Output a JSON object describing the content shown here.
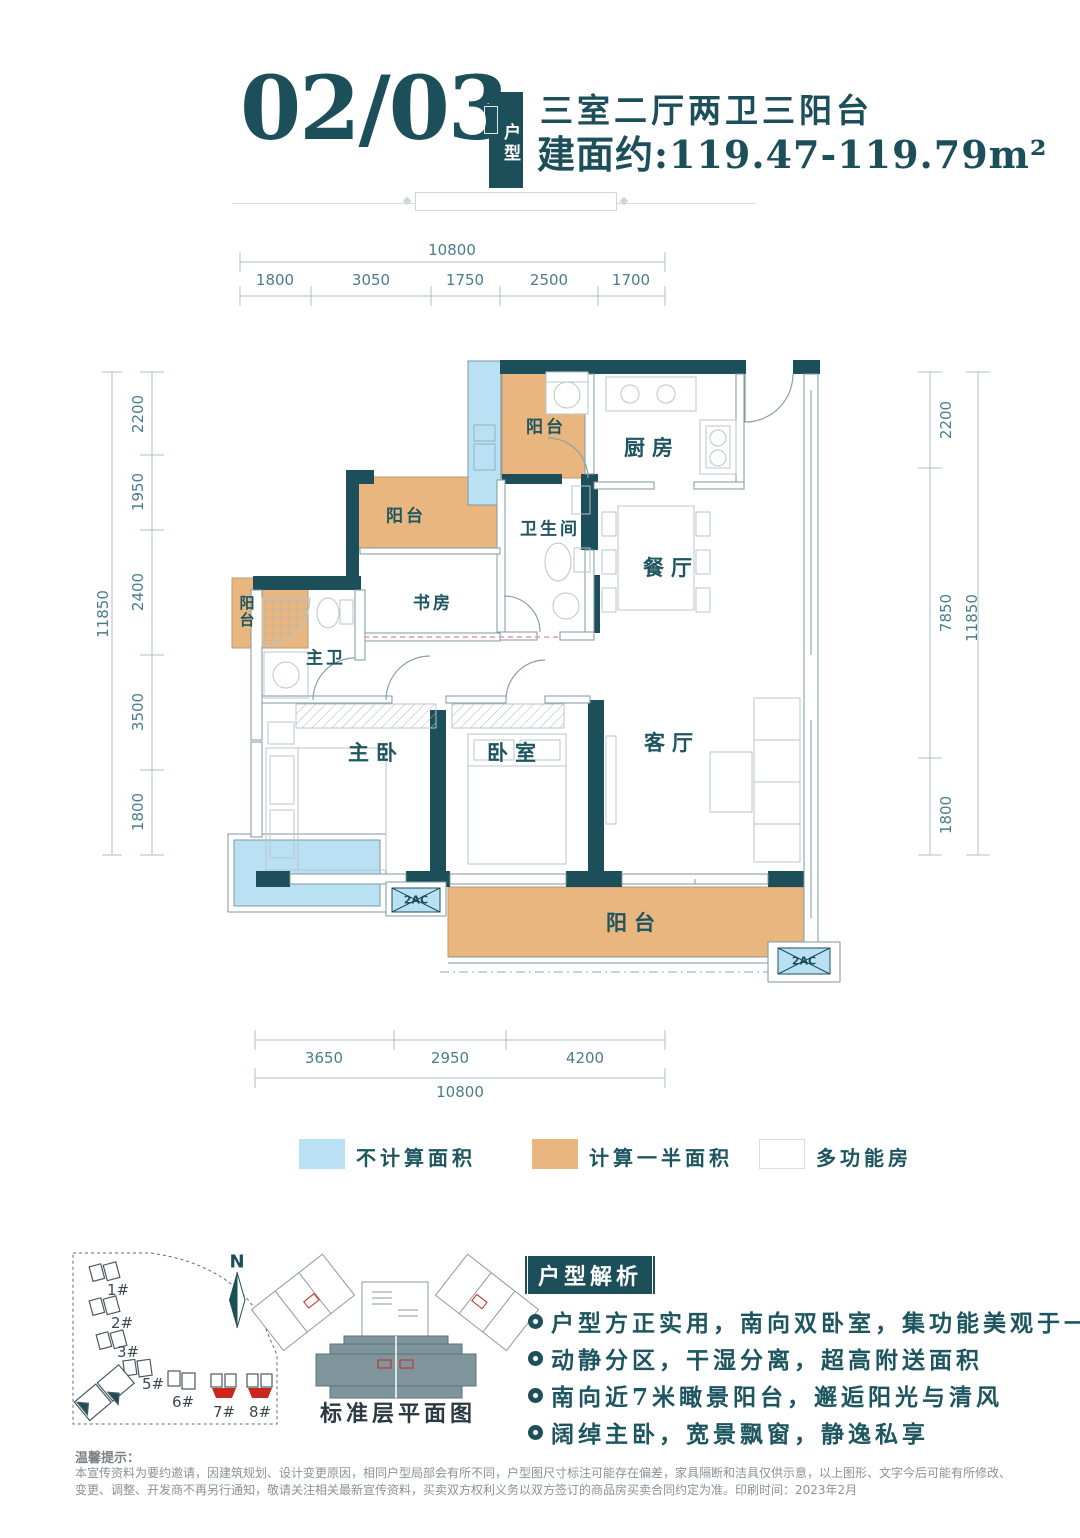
{
  "header": {
    "unit_number": "02/03",
    "badge_vertical": "户型",
    "layout_title": "三室二厅两卫三阳台",
    "area_line": "建面约:119.47-119.79m²"
  },
  "dims": {
    "top_total": "10800",
    "top_segments": [
      "1800",
      "3050",
      "1750",
      "2500",
      "1700"
    ],
    "bottom_segments": [
      "3650",
      "2950",
      "4200"
    ],
    "bottom_total": "10800",
    "left_total": "11850",
    "left_segments": [
      "2200",
      "1950",
      "2400",
      "3500",
      "1800"
    ],
    "right_segments": [
      "2200",
      "7850",
      "1800"
    ],
    "right_total": "11850"
  },
  "rooms": {
    "balcony_top": "阳台",
    "kitchen": "厨房",
    "bathroom": "卫生间",
    "dining": "餐厅",
    "balcony_mid": "阳台",
    "study": "书房",
    "master_bath": "主卫",
    "balcony_side": "阳台",
    "master_bedroom": "主卧",
    "bedroom": "卧室",
    "living_room": "客厅",
    "balcony_bottom": "阳台",
    "ac_platform": "2AC"
  },
  "legend": {
    "uncounted_label": "不计算面积",
    "half_label": "计算一半面积",
    "multi_label": "多功能房",
    "uncounted_color": "#b9e1f3",
    "half_color": "#e9b67f",
    "multi_color": "#ffffff"
  },
  "site_plan": {
    "north": "N",
    "b1": "1#",
    "b2": "2#",
    "b3": "3#",
    "b5": "5#",
    "b6": "6#",
    "b7": "7#",
    "b8": "8#"
  },
  "mini_plan": {
    "caption": "标准层平面图"
  },
  "analysis": {
    "title": "户型解析",
    "bullets": [
      "户型方正实用，南向双卧室，集功能美观于一体",
      "动静分区，干湿分离，超高附送面积",
      "南向近7米瞰景阳台，邂逅阳光与清风",
      "阔绰主卧，宽景飘窗，静逸私享"
    ]
  },
  "footer": {
    "title": "温馨提示：",
    "line1": "本宣传资料为要约邀请，因建筑规划、设计变更原因，相同户型局部会有所不同，户型图尺寸标注可能存在偏差，家具隔断和洁具仅供示意，以上图形、文字今后可能有所修改、",
    "line2": "变更、调整、开发商不再另行通知，敬请关注相关最新宣传资料，买卖双方权利义务以双方签订的商品房买卖合同约定为准。印刷时间：2023年2月"
  },
  "colors": {
    "wall": "#1c4f59",
    "balcony_fill": "#e9b67f",
    "uncounted_fill": "#b9e1f3",
    "dim_text": "#4a7d8c",
    "highlight_red": "#c8281e"
  }
}
